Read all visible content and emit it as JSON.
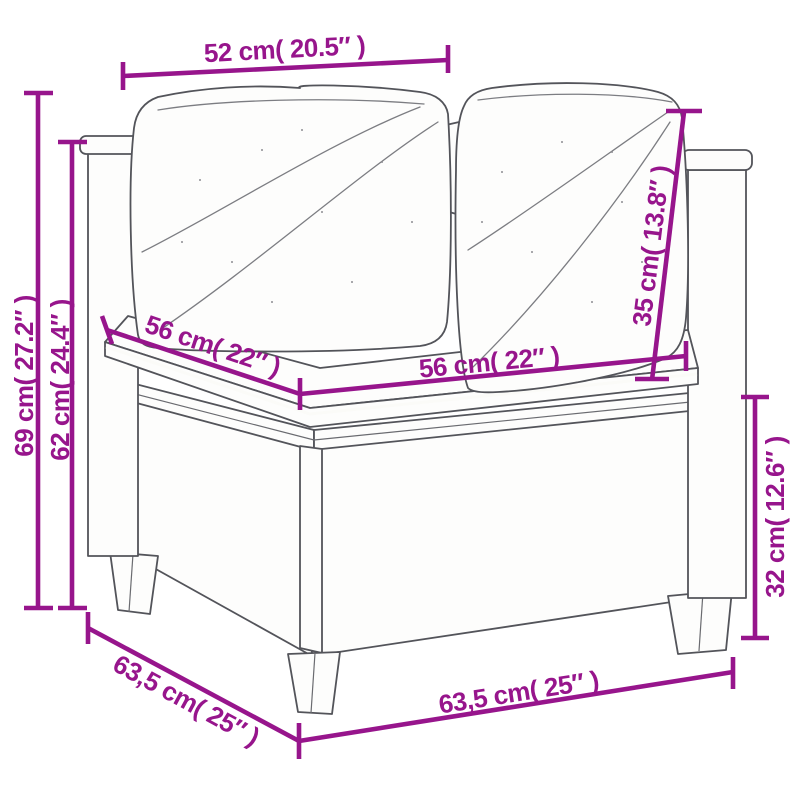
{
  "diagram": {
    "subject": "poly rattan corner sofa section with cushions (line-art dimension diagram)",
    "accent_color": "#97158c",
    "artwork_line_color": "#53545a",
    "background_color": "#ffffff"
  },
  "dimensions": {
    "top_width": "52 cm( 20.5″ )",
    "overall_height": "69 cm( 27.2″ )",
    "height_to_armrest": "62 cm( 24.4″ )",
    "seat_depth": "56 cm( 22″ )",
    "seat_width": "56 cm( 22″ )",
    "backrest_cushion_height": "35 cm( 13.8″ )",
    "base_height": "32 cm( 12.6″ )",
    "base_side_depth": "63,5 cm( 25″ )",
    "base_front_width": "63,5 cm( 25″ )"
  }
}
